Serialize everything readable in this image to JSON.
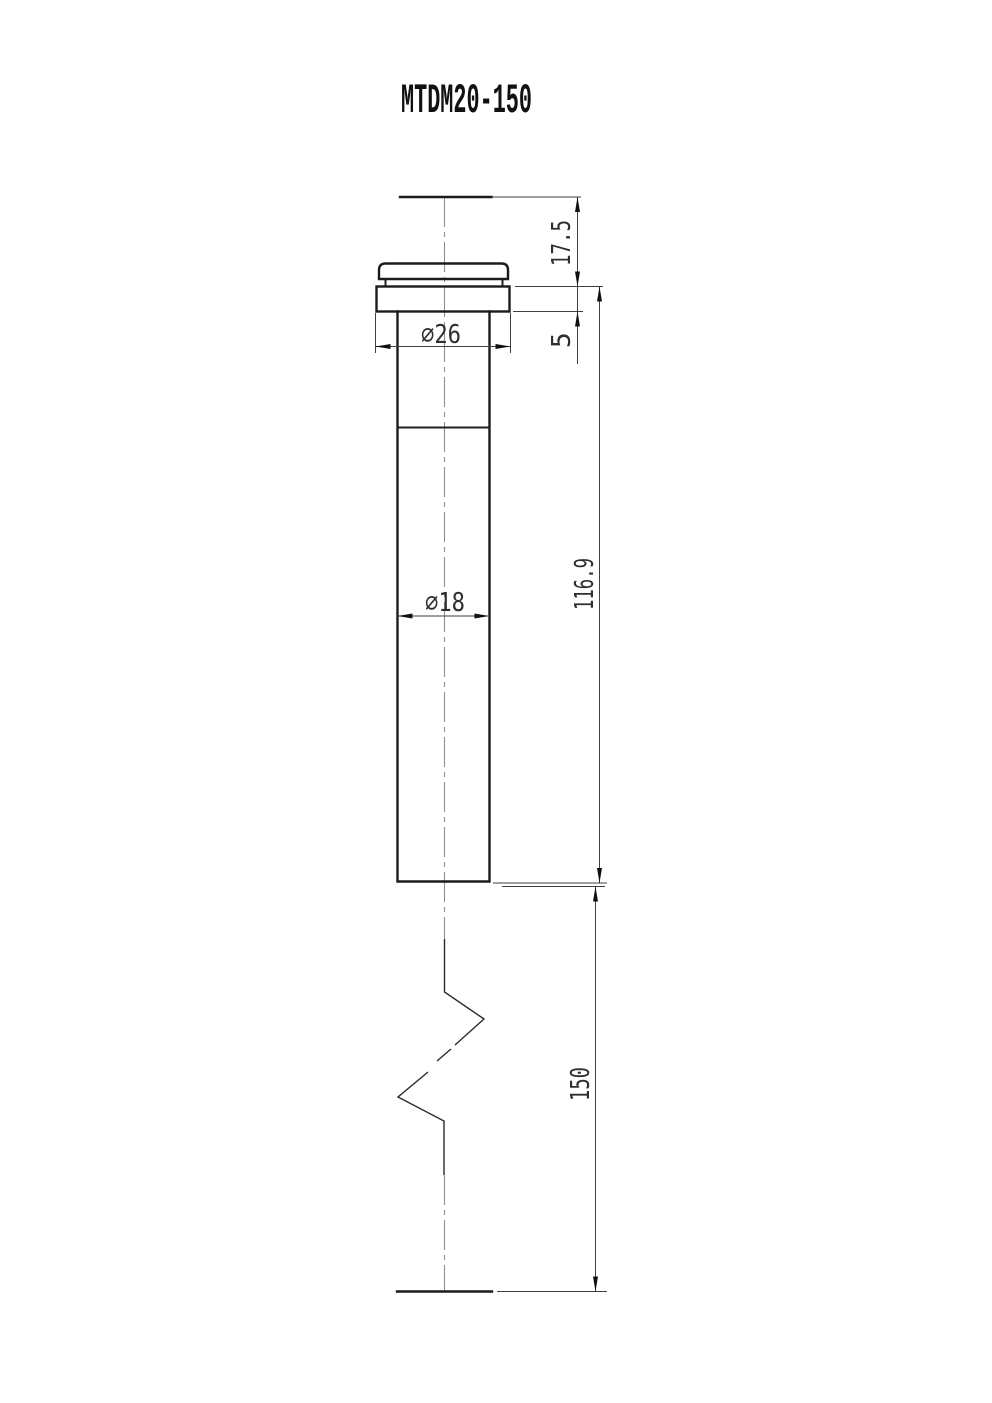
{
  "title": "MTDM20-150",
  "drawing": {
    "view": "front elevation, single part view with long-break symbol",
    "part": "flanged cylindrical pin / plunger",
    "dimensions": {
      "head_height": "17.5",
      "flange_thickness": "5",
      "flange_diameter": "∅26",
      "shaft_diameter": "∅18",
      "shaft_visible_length": "116.9",
      "total_length": "150"
    }
  }
}
